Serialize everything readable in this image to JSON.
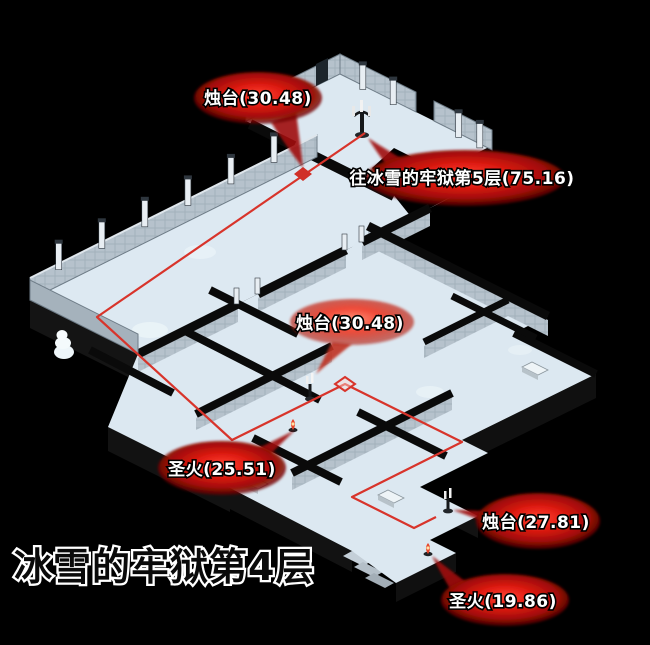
{
  "title": "冰雪的牢狱第4层",
  "colors": {
    "background": "#000000",
    "floor": "#dce8f1",
    "floor_ice": "#eef6fa",
    "wall_dark": "#0a0a0a",
    "brick_wall": "#b6c2cc",
    "route_red": "#d8342b",
    "blob_red": "#cc1612",
    "label_text": "#ffffff",
    "title_fill": "#0a0a0a",
    "title_outline": "#ffffff"
  },
  "markers": [
    {
      "id": "candlestick-1",
      "label": "烛台(30.48)"
    },
    {
      "id": "exit-floor-5",
      "label": "往冰雪的牢狱第5层(75.16)"
    },
    {
      "id": "candlestick-2",
      "label": "烛台(30.48)"
    },
    {
      "id": "holy-fire-1",
      "label": "圣火(25.51)"
    },
    {
      "id": "candlestick-3",
      "label": "烛台(27.81)"
    },
    {
      "id": "holy-fire-2",
      "label": "圣火(19.86)"
    }
  ]
}
